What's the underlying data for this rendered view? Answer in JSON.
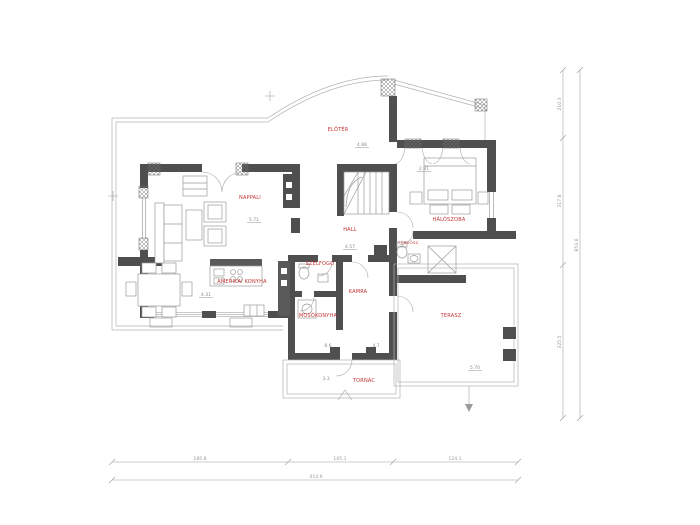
{
  "plan": {
    "rooms": {
      "corridor": {
        "label": "ELŐTÉR",
        "value": "4.88"
      },
      "living": {
        "label": "NAPPALI",
        "value": "5.71"
      },
      "hall": {
        "label": "HALL",
        "value": "4.57"
      },
      "bedroom": {
        "label": "HÁLÓSZOBA",
        "value": "2.81"
      },
      "bathroom": {
        "label": "FÜRDŐSZ."
      },
      "vestibule": {
        "label": "SZÉLFOGÓ"
      },
      "pantry": {
        "label": "KAMRA"
      },
      "laundry": {
        "label": "MOSÓKONYHA"
      },
      "kitchen": {
        "label": "AMERIKAI KONYHA",
        "value": "4.31"
      },
      "terrace": {
        "label": "TERASZ",
        "value": "5.70"
      },
      "porch": {
        "label": "TORNÁC",
        "value": "3.3"
      }
    },
    "annotations": {
      "opening_left": "8.6",
      "opening_right": "4.7"
    },
    "dimensions": {
      "bottom": {
        "segments": [
          "185.8",
          "105.1",
          "124.1"
        ],
        "total": "414.9"
      },
      "right": {
        "segments": [
          "210.3",
          "317.8",
          "325.5"
        ],
        "total": "853.6"
      }
    },
    "colors": {
      "wall": "#4f4f4f",
      "label": "#c43131",
      "dim": "#9a9a9a"
    }
  }
}
